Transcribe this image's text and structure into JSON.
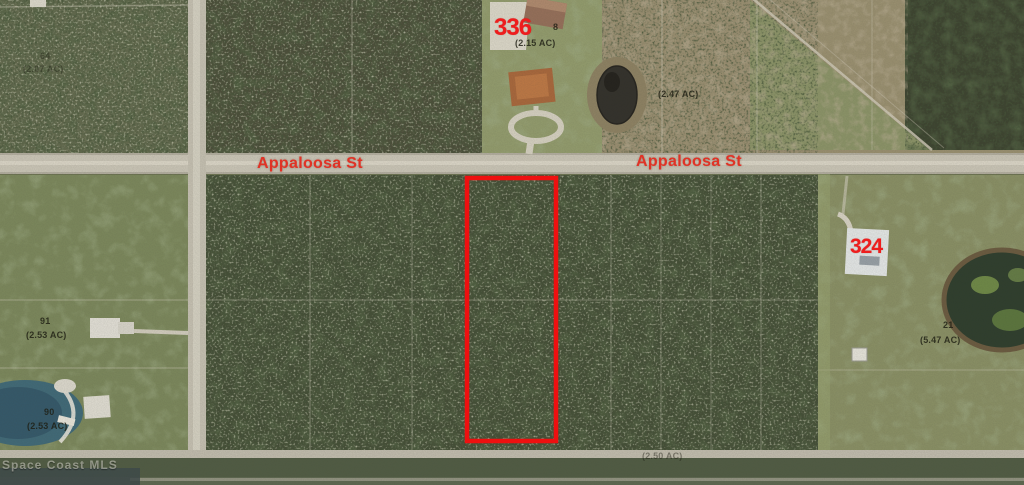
{
  "map": {
    "type": "aerial-parcel-map",
    "streets": [
      {
        "name": "Appaloosa St"
      },
      {
        "name": "Appaloosa St"
      }
    ],
    "addresses": [
      {
        "number": "336"
      },
      {
        "number": "324"
      }
    ],
    "parcels": [
      {
        "lot": "64",
        "acreage": "(2.07 AC)"
      },
      {
        "lot": "8",
        "acreage": "(2.15 AC)"
      },
      {
        "acreage": "(2.47 AC)"
      },
      {
        "lot": "91",
        "acreage": "(2.53 AC)"
      },
      {
        "lot": "90",
        "acreage": "(2.53 AC)"
      },
      {
        "lot": "21",
        "acreage": "(5.47 AC)"
      },
      {
        "acreage": "(2.50 AC)"
      }
    ],
    "watermark": "Space Coast MLS",
    "colors": {
      "street_label": "#e03326",
      "address_label": "#ee1d1d",
      "parcel_label": "#1e1e14",
      "highlight_outline": "#ee1010"
    }
  }
}
